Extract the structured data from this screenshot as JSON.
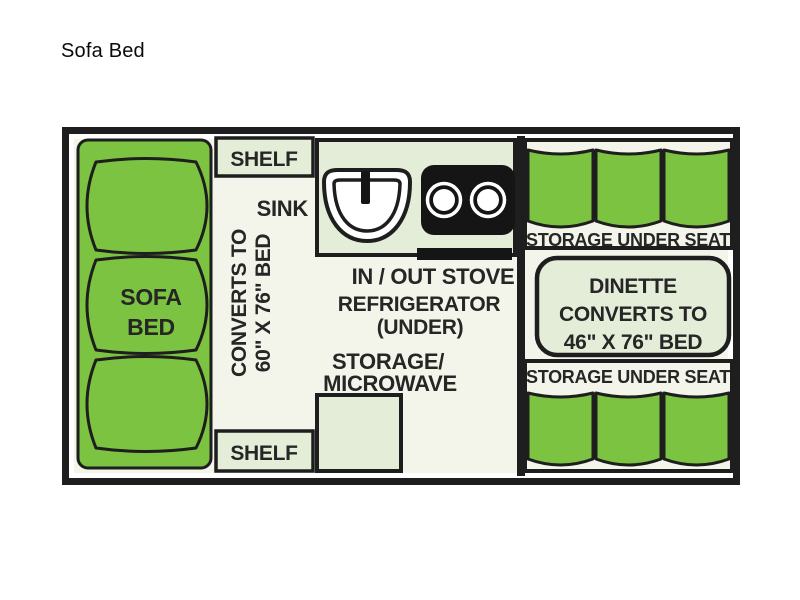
{
  "page": {
    "title": "Sofa Bed"
  },
  "floorplan": {
    "sofa": {
      "line1": "SOFA",
      "line2": "BED"
    },
    "converts": {
      "line1": "CONVERTS TO",
      "line2": "60\" X 76\" BED"
    },
    "shelf_top": "SHELF",
    "shelf_bottom": "SHELF",
    "sink_label": "SINK",
    "stove_label": "IN / OUT STOVE",
    "refrigerator": {
      "line1": "REFRIGERATOR",
      "line2": "(UNDER)"
    },
    "storage_microwave": {
      "line1": "STORAGE/",
      "line2": "MICROWAVE"
    },
    "dinette": {
      "line1": "DINETTE",
      "line2": "CONVERTS TO",
      "line3": "46\" X 76\" BED"
    },
    "seat_top_label": "STORAGE UNDER SEAT",
    "seat_bottom_label": "STORAGE UNDER SEAT"
  },
  "colors": {
    "cushion_green": "#7CC342",
    "box_fill": "#E4EDD8",
    "floor": "#F3F5EB",
    "outline": "#1E1E1E",
    "appliance_black": "#151515",
    "text": "#262626"
  }
}
